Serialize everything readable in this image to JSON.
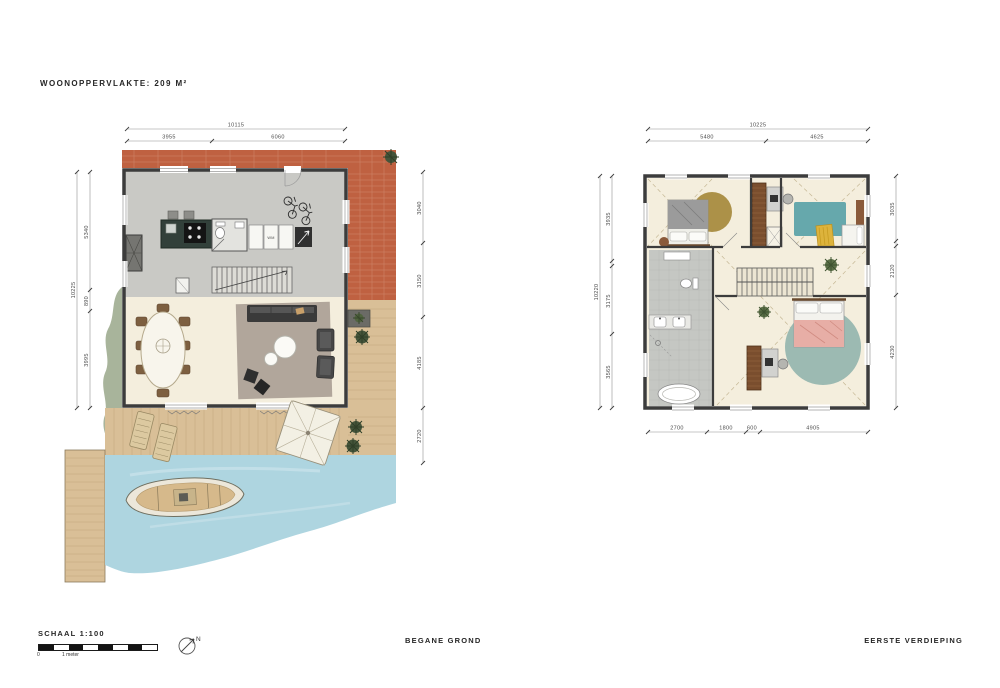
{
  "page": {
    "title": "WOONOPPERVLAKTE: 209 M²",
    "footer": {
      "scale_label": "SCHAAL 1:100",
      "scale_zero": "0",
      "scale_unit": "1 meter",
      "north": "N"
    }
  },
  "ground_floor": {
    "caption": "BEGANE GROND",
    "appliance_label": "WM",
    "dims": {
      "top_overall": "10115",
      "top_segments": [
        "3955",
        "6060"
      ],
      "left_overall": "10225",
      "left_segments": [
        "5340",
        "890",
        "3995"
      ],
      "right_segments": [
        "3040",
        "3150",
        "4185",
        "2720"
      ]
    }
  },
  "first_floor": {
    "caption": "EERSTE VERDIEPING",
    "dims": {
      "top_overall": "10225",
      "top_segments": [
        "5480",
        "4625"
      ],
      "left_overall": "10220",
      "left_segments": [
        "3935",
        "3175",
        "3565"
      ],
      "right_segments": [
        "3035",
        "2120",
        "4230"
      ],
      "bottom_segments": [
        "2700",
        "1800",
        "600",
        "4905"
      ]
    }
  },
  "colors": {
    "paper": "#ffffff",
    "brick": "#bf6141",
    "deck_wood": "#d9bf97",
    "water": "#aed5e0",
    "concrete_floor": "#c9c9c5",
    "wood_floor": "#f4eedd",
    "rug_taupe": "#b1a69b",
    "rug_teal": "#9cbab2",
    "rug_olive": "#a5893b",
    "accent_teal": "#66a8ac",
    "accent_yellow": "#ddb33c",
    "wardrobe_brown": "#7a4e2e",
    "wall_line": "#3c3c3c"
  }
}
